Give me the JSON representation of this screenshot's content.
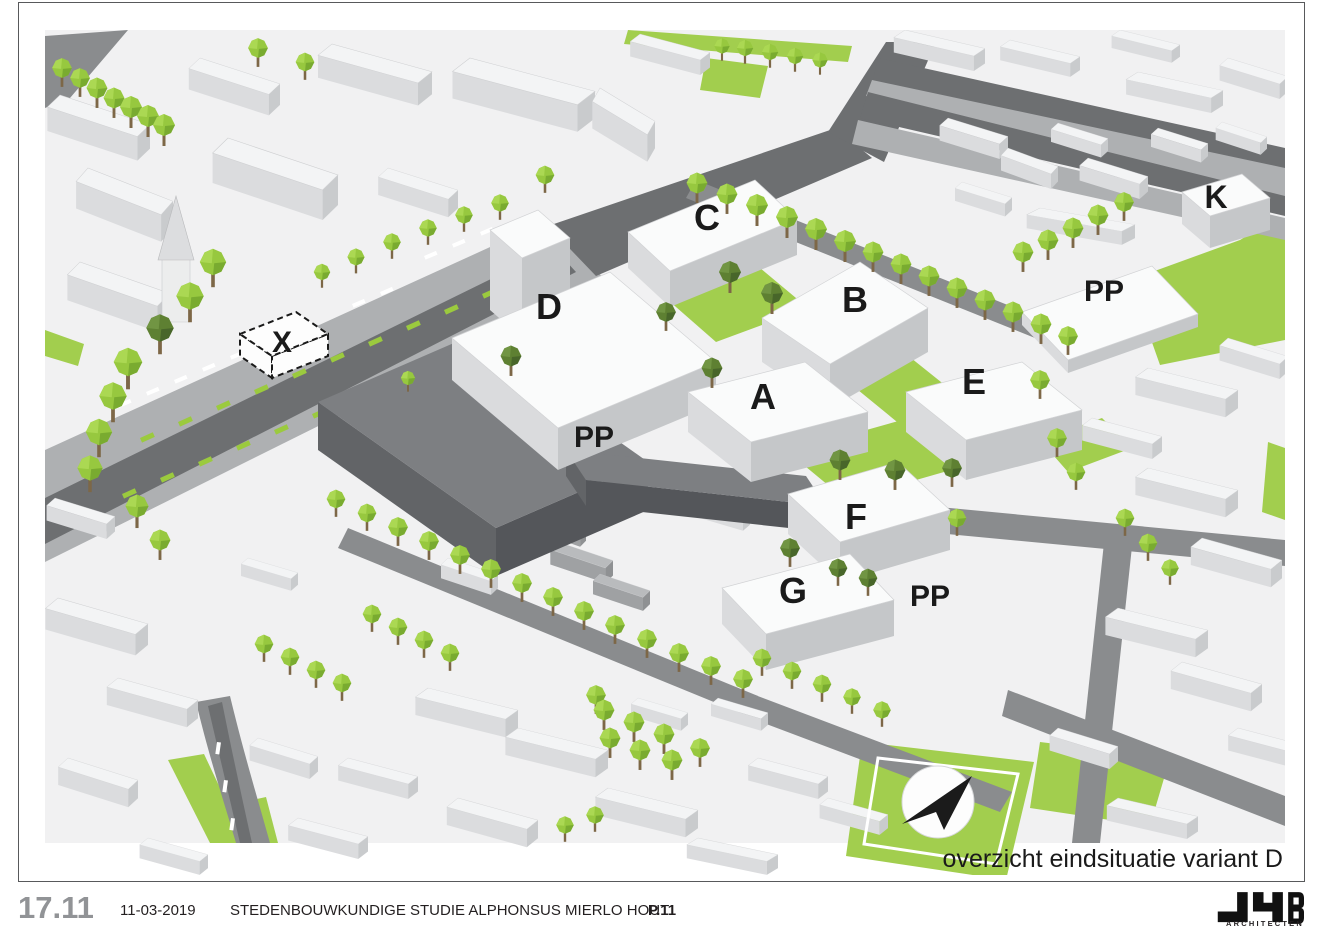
{
  "page": {
    "caption": "overzicht eindsituatie variant D"
  },
  "map": {
    "building_labels": [
      {
        "text": "C"
      },
      {
        "text": "D"
      },
      {
        "text": "B"
      },
      {
        "text": "K"
      },
      {
        "text": "PP"
      },
      {
        "text": "A"
      },
      {
        "text": "E"
      },
      {
        "text": "X"
      },
      {
        "text": "PP"
      },
      {
        "text": "F"
      },
      {
        "text": "G"
      },
      {
        "text": "PP"
      }
    ],
    "north_arrow_direction": "northeast",
    "colors": {
      "ground": "#f1f1f2",
      "road_dark": "#6d6f71",
      "green": "#a2ce4e",
      "tree_light": "#97c83f",
      "tree_dark": "#5e8032",
      "building_top": "#fafbfb",
      "building_side": "#c5c7c9",
      "existing_building_dark": "#7d7f82"
    }
  },
  "footer": {
    "figure_number": "17.11",
    "date": "11-03-2019",
    "title": "STEDENBOUWKUNDIGE STUDIE  ALPHONSUS MIERLO HOUT",
    "page_number": "P.11",
    "logo": "JYB",
    "logo_sub": "ARCHITECTEN"
  }
}
